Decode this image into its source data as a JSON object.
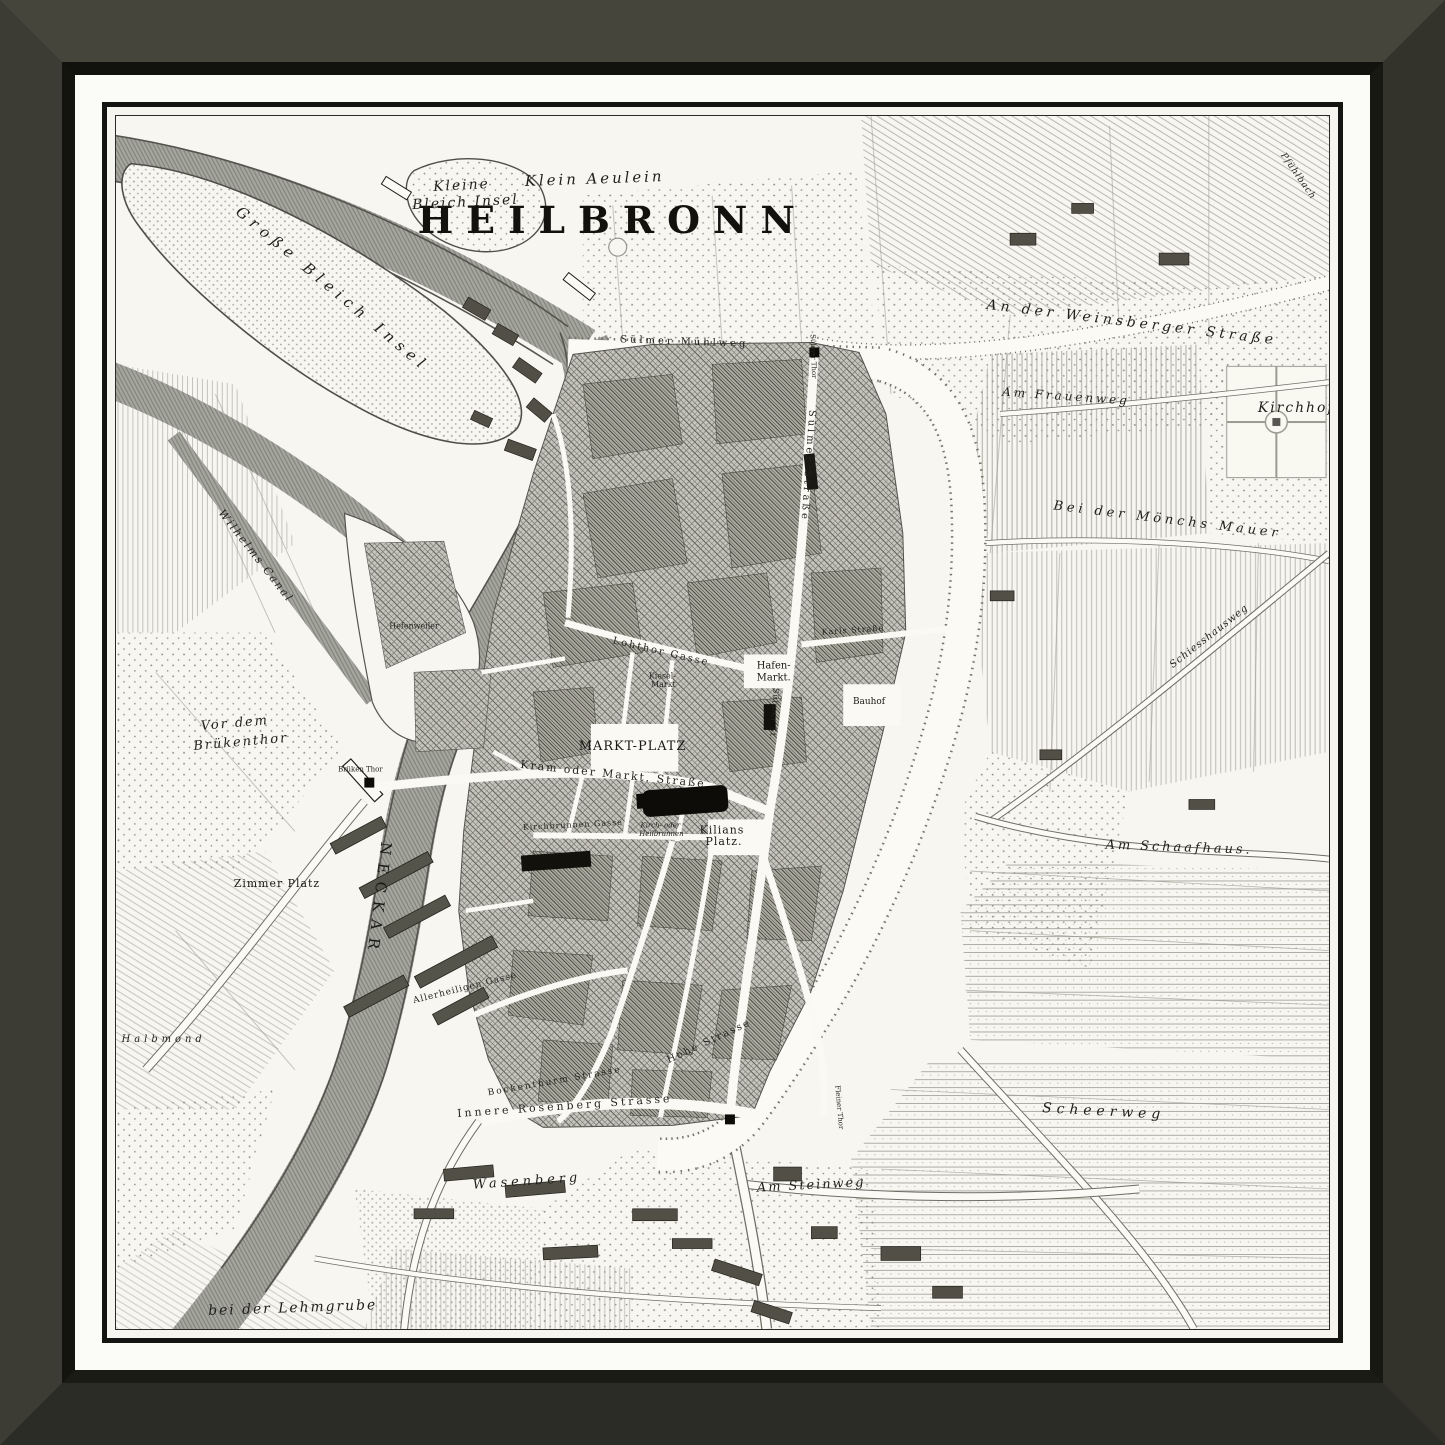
{
  "artwork": {
    "title": "HEILBRONN",
    "description": "Antique engraved city plan of Heilbronn in a dark frame with white mat",
    "frame_color": "#3a3a31",
    "frame_lip_color": "#14140f",
    "mat_color": "#fbfbf8",
    "rule_color": "#141412",
    "paper_color": "#f7f6f0",
    "ink_color": "#211f1a",
    "water_color": "#a6a79f",
    "urban_color": "#c6c5bd"
  },
  "map": {
    "title": "HEILBRONN",
    "river": "NECKAR",
    "labels": [
      {
        "t": "HEILBRONN",
        "x": 500,
        "y": 118,
        "s": 38,
        "r": 0,
        "ls": 13,
        "c": "title"
      },
      {
        "t": "Kleine",
        "x": 348,
        "y": 74,
        "s": 14,
        "r": -3,
        "ls": 2,
        "c": "it"
      },
      {
        "t": "Bleich Insel",
        "x": 352,
        "y": 91,
        "s": 14,
        "r": -3,
        "ls": 2,
        "c": "it"
      },
      {
        "t": "Klein Aeulein",
        "x": 482,
        "y": 68,
        "s": 15,
        "r": -2,
        "ls": 3,
        "c": "it"
      },
      {
        "t": "Große Bleich Insel",
        "x": 215,
        "y": 178,
        "s": 15,
        "r": 40,
        "ls": 6,
        "c": "it"
      },
      {
        "t": "Wilhelms Canal",
        "x": 138,
        "y": 445,
        "s": 11,
        "r": 52,
        "ls": 2,
        "c": "it"
      },
      {
        "t": "Hefenweiler",
        "x": 300,
        "y": 516,
        "s": 8,
        "r": 0,
        "ls": 0,
        "c": "street"
      },
      {
        "t": "Vor dem",
        "x": 120,
        "y": 615,
        "s": 13,
        "r": -5,
        "ls": 2,
        "c": "it"
      },
      {
        "t": "Brükenthor",
        "x": 126,
        "y": 634,
        "s": 13,
        "r": -5,
        "ls": 2,
        "c": "it"
      },
      {
        "t": "Brüken Thor",
        "x": 246,
        "y": 660,
        "s": 7,
        "r": 0,
        "ls": 0,
        "c": "street"
      },
      {
        "t": "Zimmer Platz",
        "x": 162,
        "y": 776,
        "s": 11,
        "r": 0,
        "ls": 1,
        "c": "caps"
      },
      {
        "t": "NECKAR",
        "x": 260,
        "y": 788,
        "s": 15,
        "r": 97,
        "ls": 8,
        "c": "caps"
      },
      {
        "t": "Halbmond",
        "x": 48,
        "y": 932,
        "s": 10,
        "r": 0,
        "ls": 4,
        "c": "it"
      },
      {
        "t": "bei der Lehmgrube",
        "x": 178,
        "y": 1204,
        "s": 14,
        "r": -2,
        "ls": 2,
        "c": "it"
      },
      {
        "t": "Wasenberg",
        "x": 414,
        "y": 1076,
        "s": 13,
        "r": -4,
        "ls": 4,
        "c": "it"
      },
      {
        "t": "Am Steinweg",
        "x": 700,
        "y": 1080,
        "s": 13,
        "r": -3,
        "ls": 2,
        "c": "it"
      },
      {
        "t": "Innere Rosenberg Strasse",
        "x": 452,
        "y": 1000,
        "s": 11,
        "r": -4,
        "ls": 3,
        "c": "street"
      },
      {
        "t": "Bockenthurm Strasse",
        "x": 442,
        "y": 974,
        "s": 9,
        "r": -10,
        "ls": 2,
        "c": "street"
      },
      {
        "t": "Allerheiligen Gasse",
        "x": 352,
        "y": 880,
        "s": 9,
        "r": -14,
        "ls": 1,
        "c": "street"
      },
      {
        "t": "Hohe Strasse",
        "x": 598,
        "y": 934,
        "s": 10,
        "r": -25,
        "ls": 2,
        "c": "street"
      },
      {
        "t": "Fleiner Thor",
        "x": 726,
        "y": 998,
        "s": 7,
        "r": 85,
        "ls": 0,
        "c": "street"
      },
      {
        "t": "MARKT-PLATZ",
        "x": 520,
        "y": 638,
        "s": 13,
        "r": 0,
        "ls": 1,
        "c": "caps"
      },
      {
        "t": "Kram oder Markt. Straße",
        "x": 500,
        "y": 666,
        "s": 11,
        "r": 6,
        "ls": 2,
        "c": "street"
      },
      {
        "t": "Kirchbrunnen Gasse",
        "x": 460,
        "y": 716,
        "s": 8,
        "r": -3,
        "ls": 1,
        "c": "street"
      },
      {
        "t": "Kirch- oder",
        "x": 548,
        "y": 716,
        "s": 7,
        "r": 0,
        "ls": 0,
        "c": "it"
      },
      {
        "t": "Heilbrunnen",
        "x": 549,
        "y": 725,
        "s": 7,
        "r": 0,
        "ls": 0,
        "c": "it"
      },
      {
        "t": "Kilians",
        "x": 610,
        "y": 722,
        "s": 11,
        "r": 0,
        "ls": 1,
        "c": "caps"
      },
      {
        "t": "Platz.",
        "x": 612,
        "y": 734,
        "s": 11,
        "r": 0,
        "ls": 1,
        "c": "caps"
      },
      {
        "t": "Lohthor Gasse",
        "x": 548,
        "y": 542,
        "s": 10,
        "r": 13,
        "ls": 2,
        "c": "street"
      },
      {
        "t": "Kiesel-",
        "x": 550,
        "y": 566,
        "s": 8,
        "r": 0,
        "ls": 0,
        "c": "street"
      },
      {
        "t": "Markt",
        "x": 551,
        "y": 575,
        "s": 8,
        "r": 0,
        "ls": 0,
        "c": "street"
      },
      {
        "t": "Hafen-",
        "x": 662,
        "y": 556,
        "s": 10,
        "r": 0,
        "ls": 0,
        "c": "caps"
      },
      {
        "t": "Markt.",
        "x": 662,
        "y": 568,
        "s": 10,
        "r": 0,
        "ls": 0,
        "c": "caps"
      },
      {
        "t": "Karls Straße",
        "x": 742,
        "y": 520,
        "s": 8,
        "r": -4,
        "ls": 1,
        "c": "street"
      },
      {
        "t": "Bauhof",
        "x": 758,
        "y": 592,
        "s": 9,
        "r": 0,
        "ls": 0,
        "c": "caps"
      },
      {
        "t": "Sülmer Straße",
        "x": 694,
        "y": 352,
        "s": 10,
        "r": 94,
        "ls": 3,
        "c": "street"
      },
      {
        "t": "Sülmer St.",
        "x": 660,
        "y": 602,
        "s": 8,
        "r": 94,
        "ls": 1,
        "c": "street"
      },
      {
        "t": "Sülmer Mühlweg",
        "x": 572,
        "y": 230,
        "s": 10,
        "r": 2,
        "ls": 3,
        "c": "street"
      },
      {
        "t": "Sülmer Thor",
        "x": 700,
        "y": 242,
        "s": 7,
        "r": 88,
        "ls": 0,
        "c": "street"
      },
      {
        "t": "An der Weinsberger Straße",
        "x": 1022,
        "y": 212,
        "s": 14,
        "r": 7,
        "ls": 4,
        "c": "it"
      },
      {
        "t": "Am Frauenweg",
        "x": 956,
        "y": 286,
        "s": 12,
        "r": 4,
        "ls": 3,
        "c": "it"
      },
      {
        "t": "Kirchhof",
        "x": 1188,
        "y": 298,
        "s": 14,
        "r": 0,
        "ls": 2,
        "c": "it"
      },
      {
        "t": "Bei der Mönchs Mauer",
        "x": 1058,
        "y": 410,
        "s": 13,
        "r": 7,
        "ls": 4,
        "c": "it"
      },
      {
        "t": "Am Schaafhaus.",
        "x": 1070,
        "y": 740,
        "s": 13,
        "r": 2,
        "ls": 3,
        "c": "it"
      },
      {
        "t": "Scheerweg",
        "x": 994,
        "y": 1006,
        "s": 14,
        "r": 3,
        "ls": 5,
        "c": "it"
      },
      {
        "t": "Schiesshausweg",
        "x": 1102,
        "y": 526,
        "s": 10,
        "r": -38,
        "ls": 1,
        "c": "it"
      },
      {
        "t": "Pfühlbach",
        "x": 1188,
        "y": 62,
        "s": 9,
        "r": 55,
        "ls": 1,
        "c": "it"
      }
    ]
  }
}
